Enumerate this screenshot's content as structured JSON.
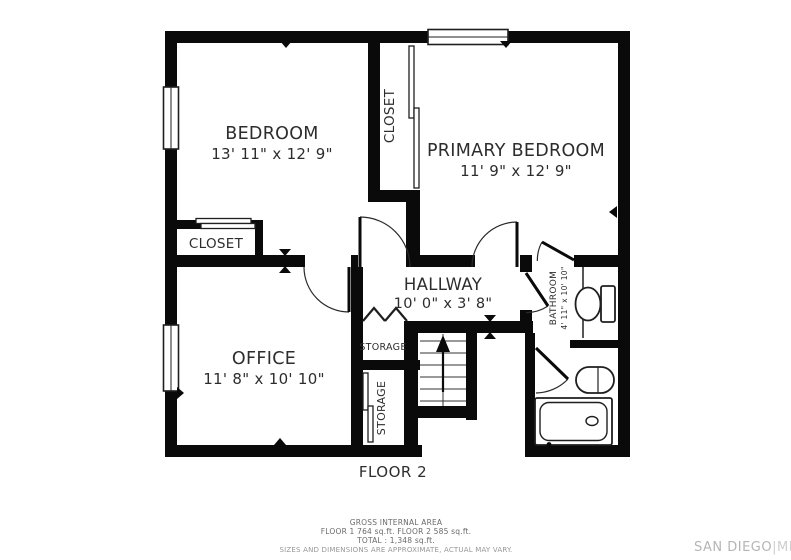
{
  "plan": {
    "floor_label": "FLOOR 2",
    "rooms": {
      "bedroom": {
        "name": "BEDROOM",
        "dims": "13' 11\" x 12' 9\""
      },
      "primary_bedroom": {
        "name": "PRIMARY BEDROOM",
        "dims": "11' 9\" x 12' 9\""
      },
      "hallway": {
        "name": "HALLWAY",
        "dims": "10' 0\" x 3' 8\""
      },
      "office": {
        "name": "OFFICE",
        "dims": "11' 8\" x 10' 10\""
      },
      "bathroom": {
        "name": "BATHROOM",
        "dims": "4' 11\" x 10' 10\""
      },
      "closet_upper": {
        "name": "CLOSET"
      },
      "closet_lower": {
        "name": "CLOSET"
      },
      "storage_upper": {
        "name": "STORAGE"
      },
      "storage_lower": {
        "name": "STORAGE"
      }
    }
  },
  "footer": {
    "gross_title": "GROSS INTERNAL AREA",
    "floors_line": "FLOOR 1 764 sq.ft.   FLOOR 2 585 sq.ft.",
    "total_line": "TOTAL :  1,348 sq.ft.",
    "disclaimer": "SIZES AND DIMENSIONS ARE APPROXIMATE, ACTUAL MAY VARY.",
    "watermark_brand": "SAN DIEGO",
    "watermark_suffix": "|MLS"
  },
  "colors": {
    "wall": "#0a0a0a",
    "line": "#1f1f1f",
    "text": "#2d2d2d",
    "muted": "#6a6a6a",
    "faint": "#979797",
    "watermark": "#c0c0c0"
  }
}
